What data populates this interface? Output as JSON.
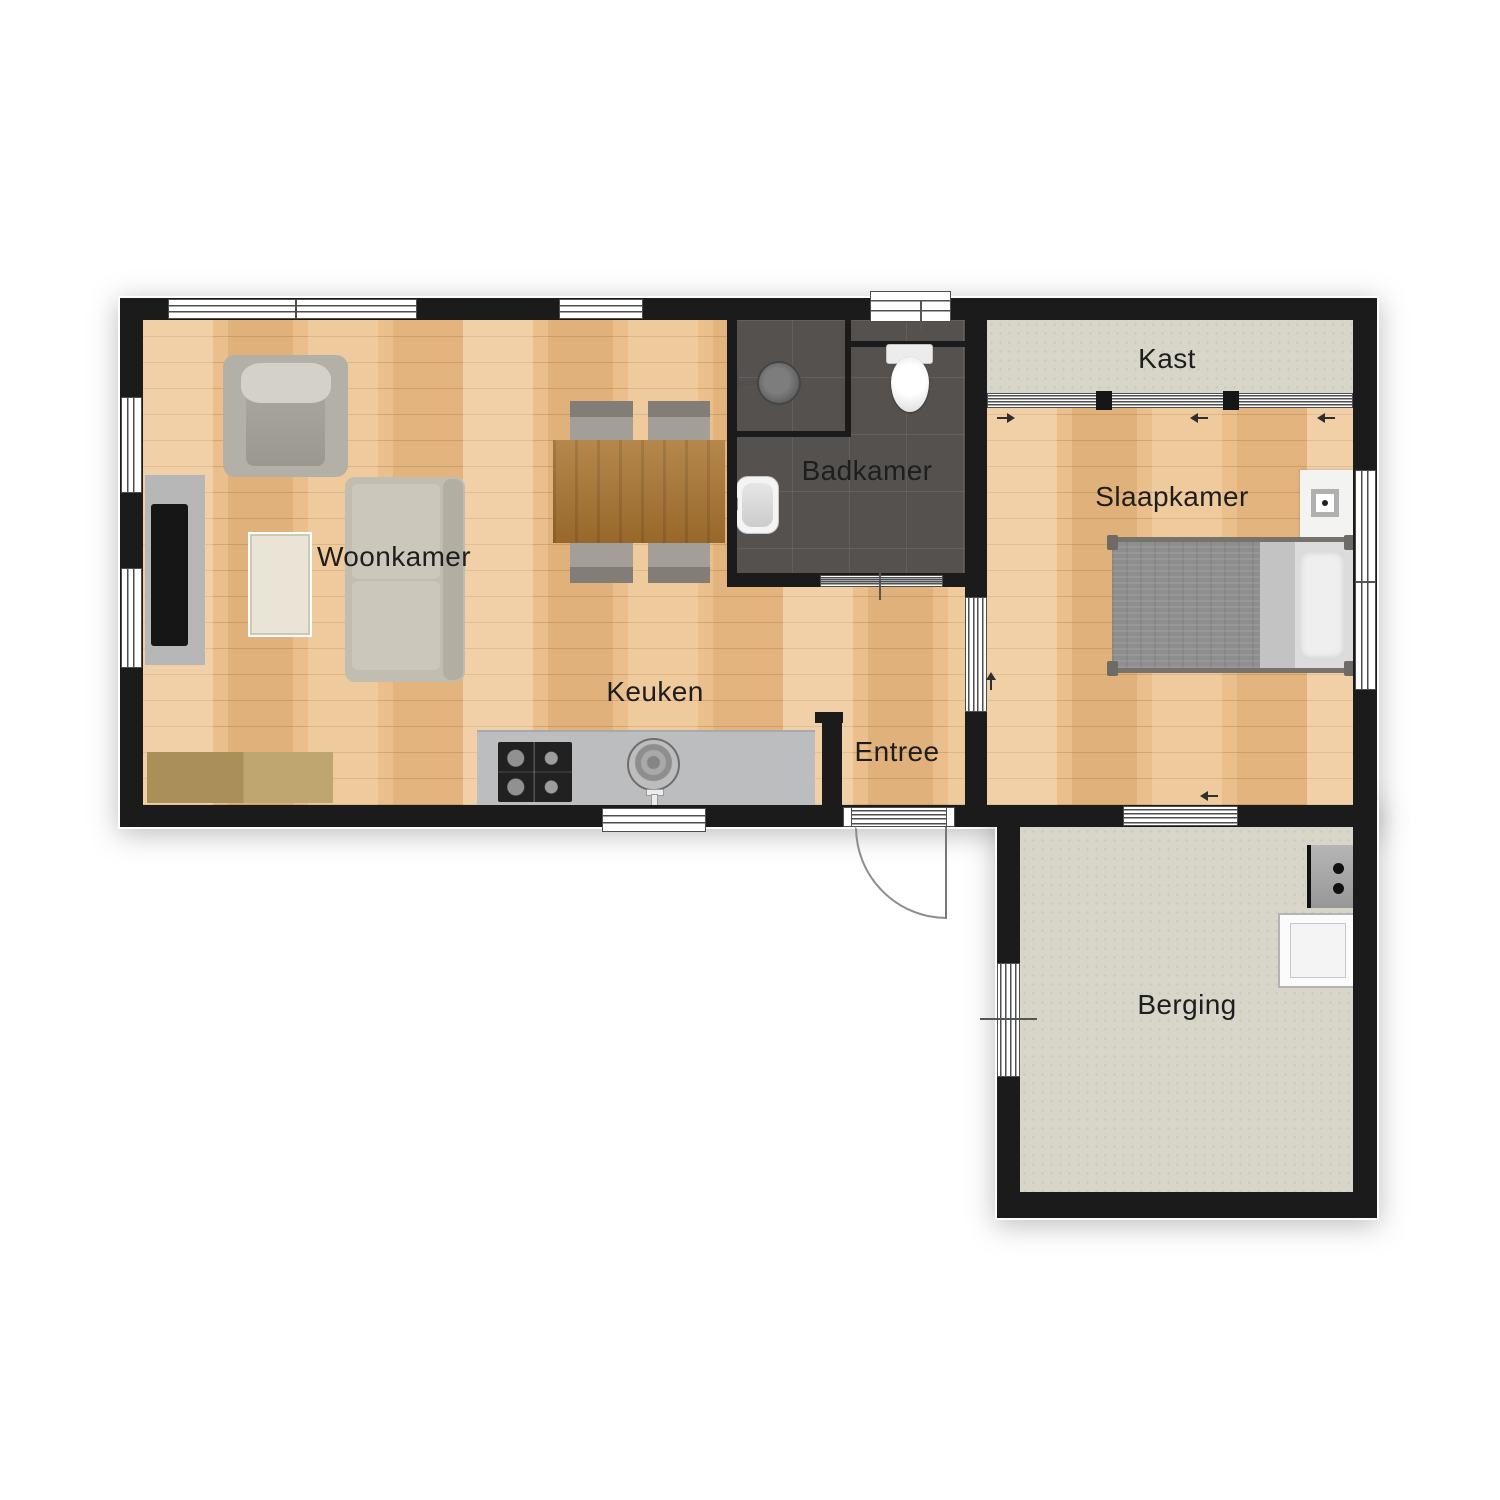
{
  "page": {
    "type": "floor-plan",
    "background": "#ffffff"
  },
  "rooms": {
    "woonkamer": "Woonkamer",
    "keuken": "Keuken",
    "badkamer": "Badkamer",
    "entree": "Entree",
    "kast": "Kast",
    "slaapkamer": "Slaapkamer",
    "berging": "Berging"
  },
  "colors": {
    "wall": "#1b1b1b",
    "wood_floor": "#ebbf8b",
    "bathroom_tile": "#55514e",
    "storage_floor": "#d8d5c9",
    "counter": "#bcbdbf",
    "table_wood": "#a9742f",
    "sofa": "#c1beb1",
    "bed_blanket": "#8e8e8e"
  },
  "furniture_icons": [
    "tv-console-icon",
    "tv-icon",
    "armchair-icon",
    "sofa-icon",
    "rug-icon",
    "sideboard-icon",
    "dining-table-icon",
    "dining-chair-icon",
    "kitchen-counter-icon",
    "stove-icon",
    "kitchen-sink-icon",
    "shower-icon",
    "washbasin-icon",
    "toilet-icon",
    "bed-icon",
    "nightstand-icon",
    "boiler-icon",
    "washing-machine-icon",
    "entrance-door-icon",
    "sliding-door-arrow-icon",
    "window-icon"
  ]
}
